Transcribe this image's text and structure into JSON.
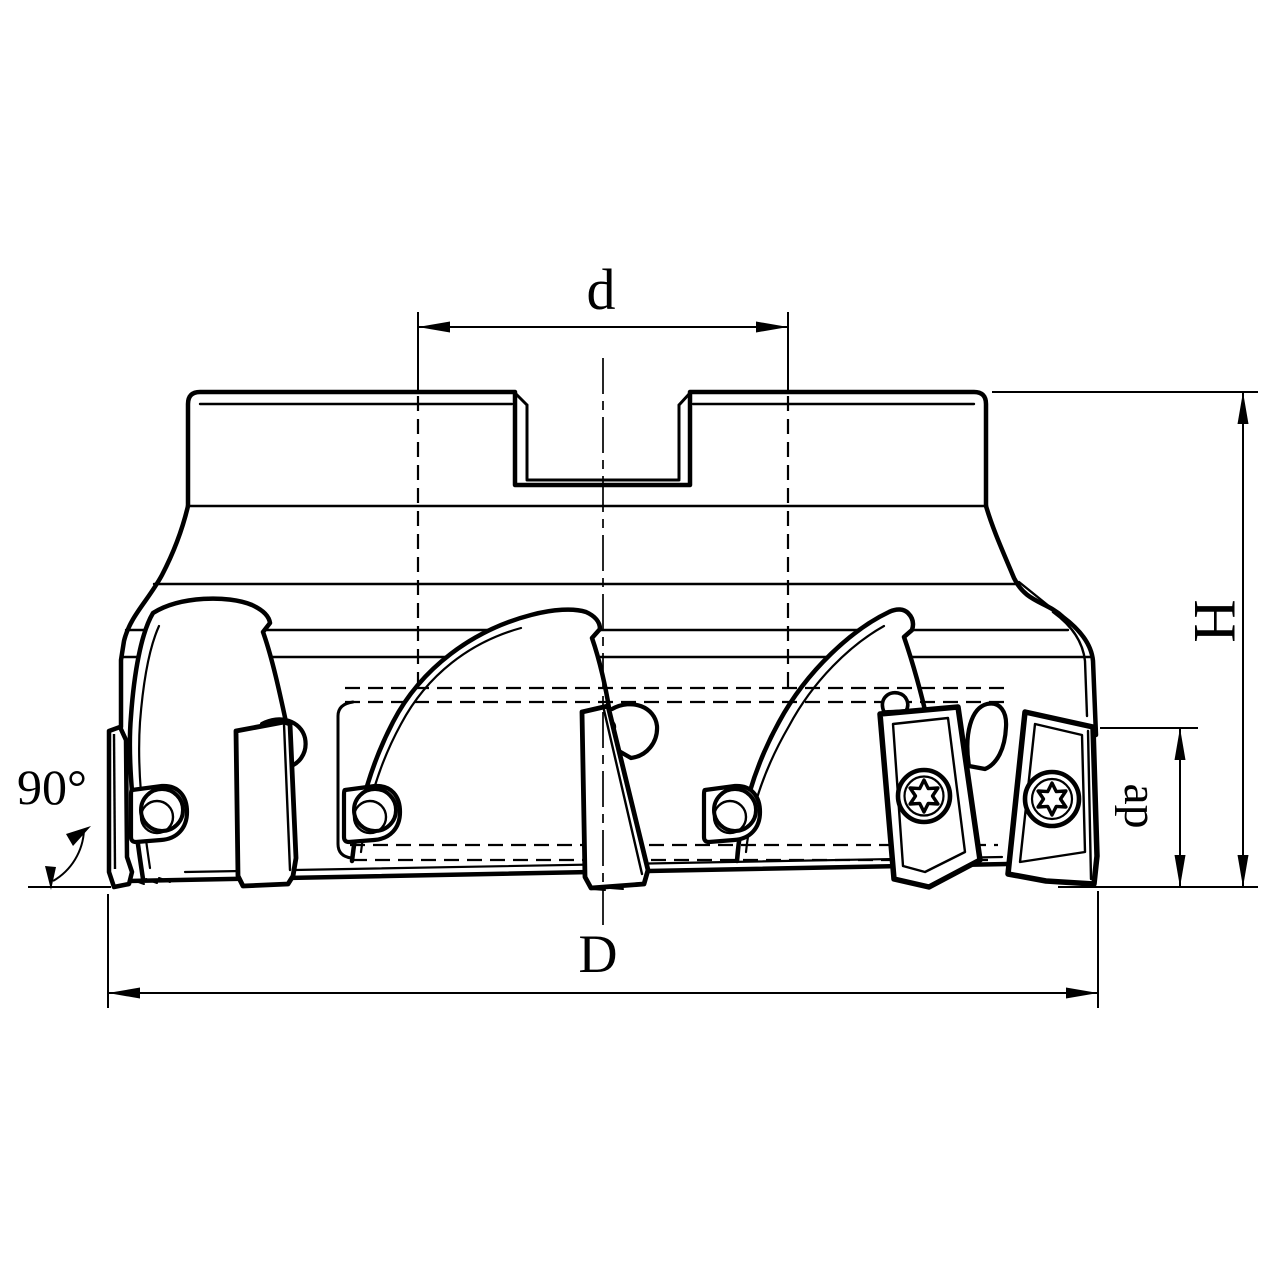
{
  "drawing": {
    "background": "#ffffff",
    "line_color": "#000000",
    "annotations": {
      "top_width_label": "d",
      "diameter_label": "D",
      "height_label": "H",
      "cut_depth_label": "ap",
      "corner_angle_label": "90°"
    }
  }
}
